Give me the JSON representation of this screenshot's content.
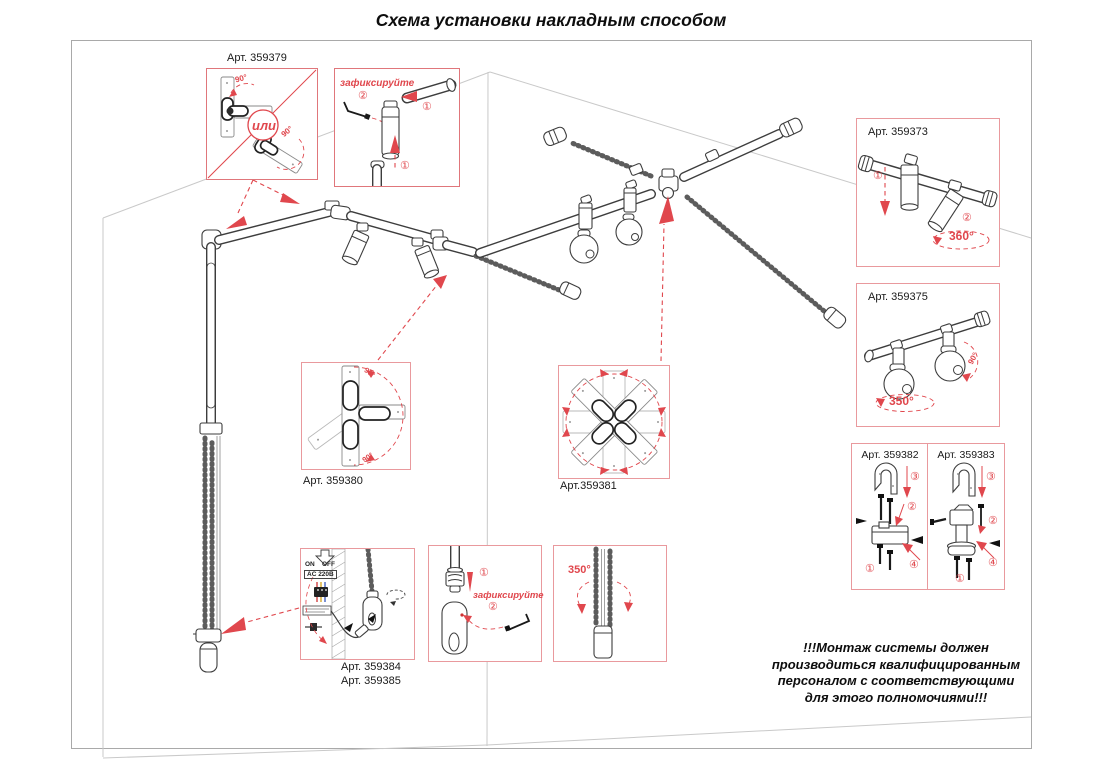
{
  "title": "Схема установки накладным способом",
  "colors": {
    "accent_red": "#e0474d",
    "callout_border": "#e9999d",
    "line_art": "#3d3d3d",
    "room_line": "#c9c9c9"
  },
  "callouts": {
    "art_359379": {
      "label": "Арт. 359379",
      "or": "или",
      "angle_a": "90°",
      "angle_b": "90°"
    },
    "fix_top": {
      "caption": "зафиксируйте",
      "step_1": "①",
      "step_2": "②"
    },
    "art_359373": {
      "label": "Арт. 359373",
      "step_1": "①",
      "step_2": "②",
      "rotation": "360°"
    },
    "art_359375": {
      "label": "Арт. 359375",
      "rotation_main": "350°",
      "rotation_side": "90°"
    },
    "art_359380": {
      "label": "Арт. 359380",
      "angle_top": "90°",
      "angle_bottom": "90°"
    },
    "art_359381": {
      "label": "Арт.359381"
    },
    "art_359382": {
      "label": "Арт. 359382",
      "step_1": "①",
      "step_2": "②",
      "step_3": "③",
      "step_4": "④"
    },
    "art_359383": {
      "label": "Арт. 359383",
      "step_1": "①",
      "step_2": "②",
      "step_3": "③",
      "step_4": "④"
    },
    "art_359384_385": {
      "label_1": "Арт. 359384",
      "label_2": "Арт. 359385",
      "on": "ON",
      "off": "OFF",
      "power": "AC 220В"
    },
    "fix_bottom": {
      "caption": "зафиксируйте",
      "step_1": "①",
      "step_2": "②"
    },
    "rot_350": {
      "rotation": "350°"
    }
  },
  "warning": {
    "line1": "!!!Монтаж системы должен",
    "line2": "производиться квалифицированным",
    "line3": "персоналом с соответствующими",
    "line4": "для этого полномочиями!!!"
  }
}
